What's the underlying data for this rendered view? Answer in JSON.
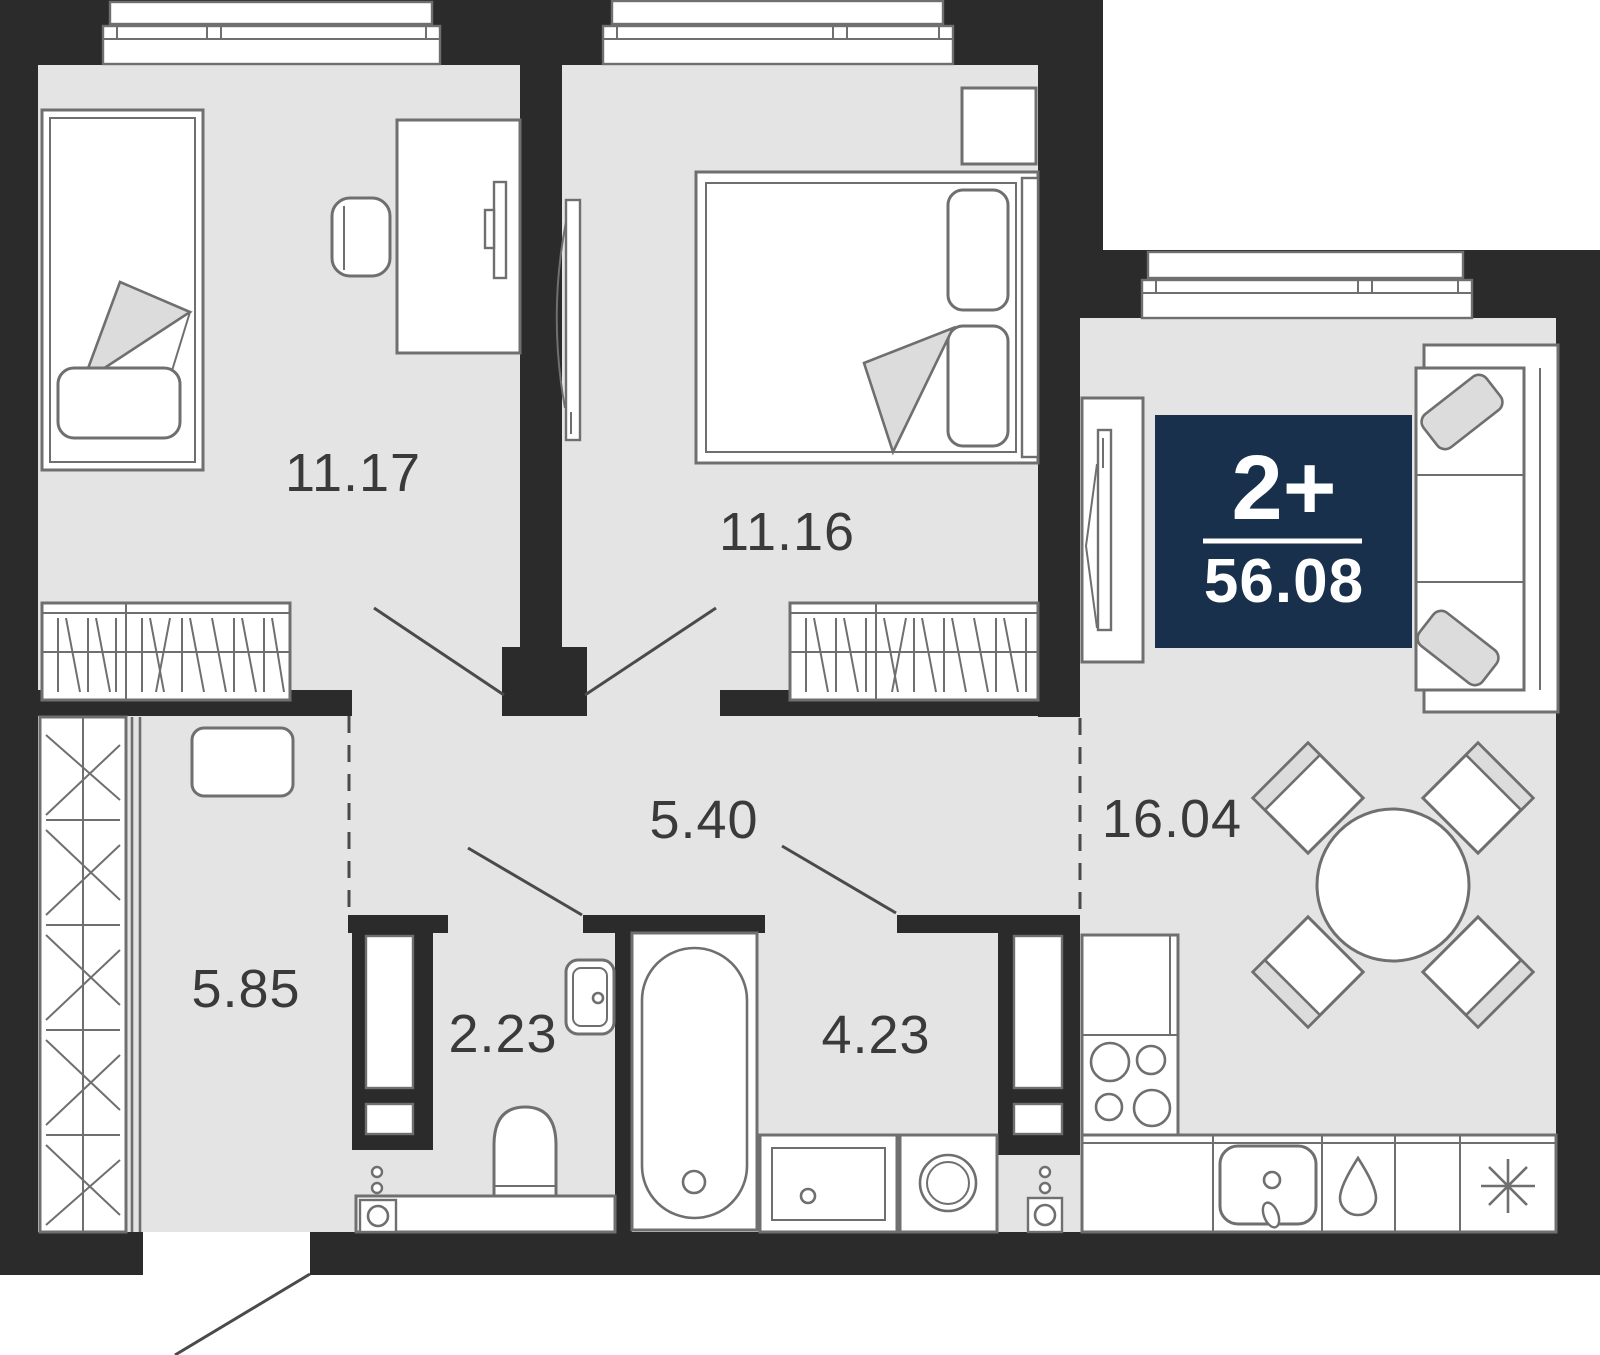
{
  "plan": {
    "badge": {
      "type_label": "2+",
      "area_value": "56.08"
    },
    "rooms": [
      {
        "id": "bedroom-1",
        "area_label": "11.17"
      },
      {
        "id": "bedroom-2",
        "area_label": "11.16"
      },
      {
        "id": "corridor",
        "area_label": "5.40"
      },
      {
        "id": "kitchen-living",
        "area_label": "16.04"
      },
      {
        "id": "entry-hall",
        "area_label": "5.85"
      },
      {
        "id": "wc",
        "area_label": "2.23"
      },
      {
        "id": "bathroom",
        "area_label": "4.23"
      }
    ]
  },
  "colors": {
    "wall": "#2b2b2b",
    "floor": "#e4e4e4",
    "line": "#6f6f6f",
    "line_dark": "#4a4a4a",
    "soft": "#dcdcdc",
    "accent": "#18304b",
    "label": "#3a3a3a",
    "paper": "#ffffff"
  }
}
